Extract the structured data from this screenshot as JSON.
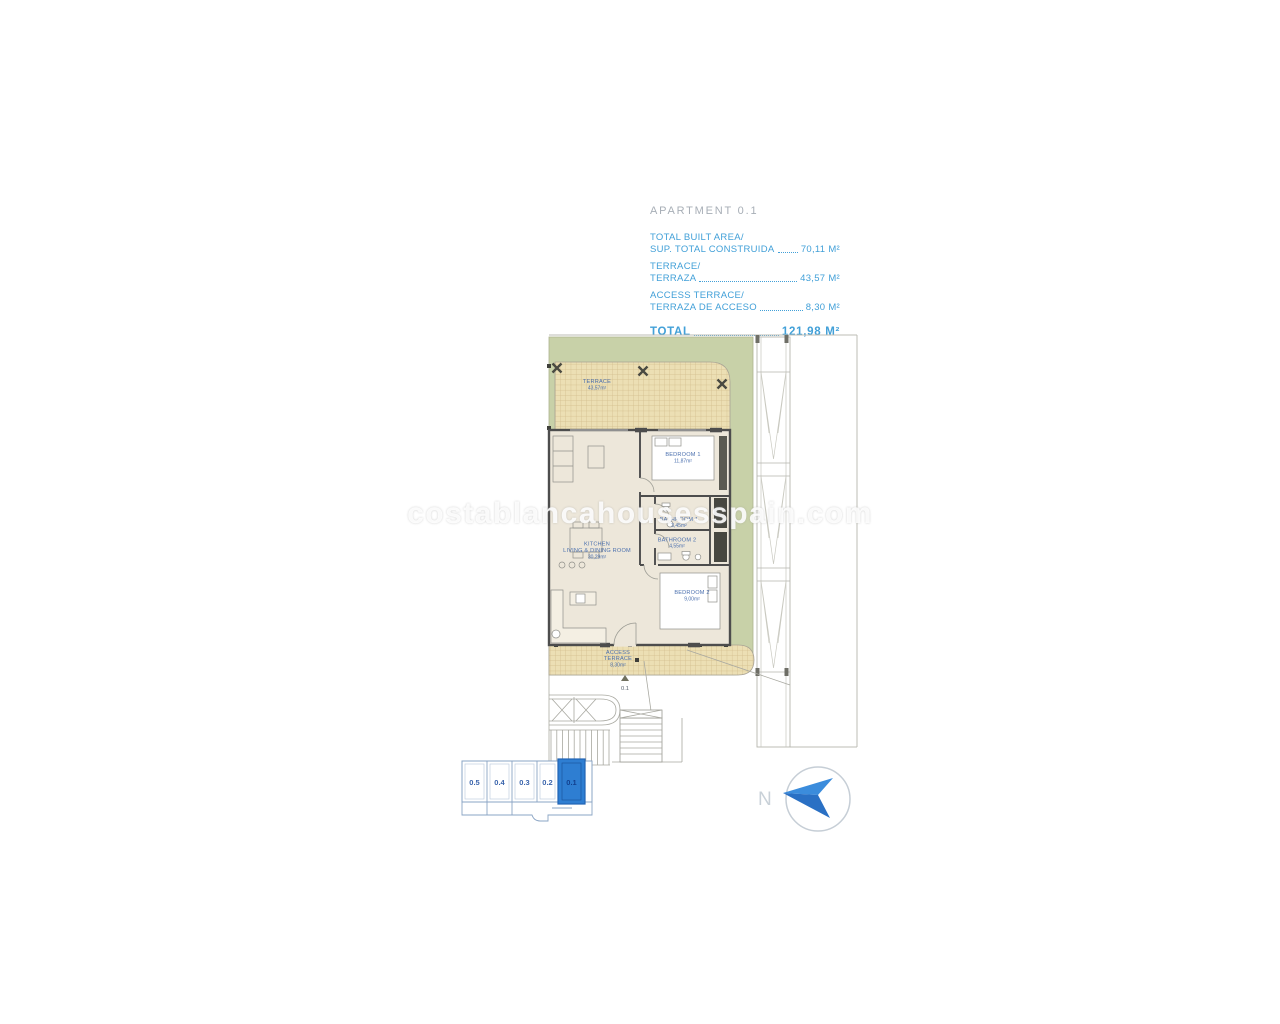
{
  "header": {
    "title": "APARTMENT 0.1",
    "rows": [
      {
        "line1": "TOTAL BUILT AREA/",
        "line2": "SUP. TOTAL CONSTRUIDA",
        "value": "70,11 M²"
      },
      {
        "line1": "TERRACE/",
        "line2": "TERRAZA",
        "value": "43,57 M²"
      },
      {
        "line1": "ACCESS TERRACE/",
        "line2": "TERRAZA DE ACCESO",
        "value": "8,30 M²"
      }
    ],
    "total": {
      "label": "TOTAL",
      "value": "121,98 M²"
    }
  },
  "floorplan": {
    "rooms": {
      "terrace": {
        "name": "TERRACE",
        "area": "43,57m²"
      },
      "bedroom1": {
        "name": "BEDROOM 1",
        "area": "11,87m²"
      },
      "bathroom1": {
        "name": "BATHROOM 1",
        "area": "3,45m²"
      },
      "bathroom2": {
        "name": "BATHROOM 2",
        "area": "4,55m²"
      },
      "bedroom2": {
        "name": "BEDROOM 2",
        "area": "9,00m²"
      },
      "kitchen": {
        "name1": "KITCHEN",
        "name2": "LIVING & DINING ROOM",
        "area": "30,29m²"
      },
      "access_terrace": {
        "name1": "ACCESS",
        "name2": "TERRACE",
        "area": "8,30m²"
      }
    },
    "entrance_label": "0.1"
  },
  "keyplan": {
    "units": [
      {
        "label": "0.5"
      },
      {
        "label": "0.4"
      },
      {
        "label": "0.3"
      },
      {
        "label": "0.2"
      },
      {
        "label": "0.1",
        "selected": true
      }
    ]
  },
  "compass": {
    "label": "N"
  },
  "watermark": {
    "text": "costablancahousesspain.com"
  },
  "colors": {
    "accent_blue": "#42a0d8",
    "title_gray": "#a7aeb6",
    "plan_green": "#c8d1a8",
    "hatch_fill": "#ecdfb4",
    "wall": "#4d4d4d",
    "room_label": "#4a6fae",
    "selected_unit": "#2e7ed2",
    "compass_blue": "#2f7ecf"
  }
}
